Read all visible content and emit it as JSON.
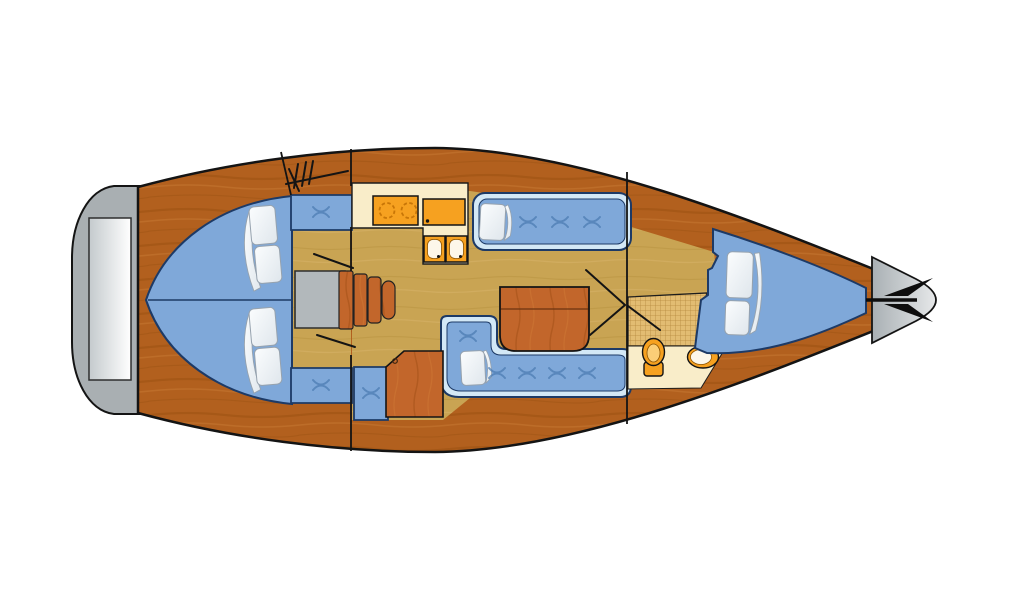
{
  "page": {
    "background": "#ffffff",
    "description": "Top-view interior floor plan of a sailing yacht (bow pointing right)"
  },
  "colors": {
    "page-bg": "#ffffff",
    "outline": "#141414",
    "hull-base": "#b2601e",
    "hull-grain-dark": "#99500f",
    "hull-grain-light": "#c87a33",
    "floor-base": "#c9a453",
    "floor-grain-dark": "#b8923f",
    "floor-grain-light": "#d6b269",
    "furniture-wood": "#c2662b",
    "furn-grain-dark": "#a34f16",
    "furn-grain-light": "#d07a36",
    "counter-cream": "#f9edc9",
    "fixture-orange": "#f6a120",
    "fixture-orange-light": "#fbce77",
    "basin-white": "#fdf7ea",
    "burner-ring": "#c87607",
    "cushion-blue": "#7fa8d9",
    "cushion-rim": "#d3e8f6",
    "cushion-outline": "#1d3a66",
    "stitch-blue": "#4d7db3",
    "pillow-white": "#fbfdfe",
    "pillow-shade": "#dfe6ec",
    "pillow-outline": "#96a2ae",
    "platform-gray": "#a9afb2",
    "step-gray": "#c4cacd",
    "step-white": "#ffffff",
    "box-gray": "#b2b8bb",
    "bow-gray-dark": "#a9b0b4",
    "bow-gray-light": "#e6e8e9",
    "checker-tile": "#e2bc72",
    "checker-line": "#b68a3e",
    "anchor-black": "#0d0d0d",
    "wood-line": "#6b3410"
  },
  "icons": {
    "anchor-icon": "bow anchor / windlass glyph",
    "companionway-hatch-icon": "hatch tick-mark glyph",
    "cushion-stitch-icon": "x-stitch cushion button",
    "stove-burner-icon": "dashed-ring burner"
  },
  "areas": {
    "stern_platform": "swim platform",
    "aft_cabins": "two aft double berths",
    "companionway": "engine box and steps",
    "galley": "stove, icebox, double sink",
    "salon": "port settee, starboard L-settee, folding table, chart table",
    "head": "toilet and wash basin with tiled floor",
    "forward_cabin": "V-berth",
    "bow": "anchor locker"
  }
}
